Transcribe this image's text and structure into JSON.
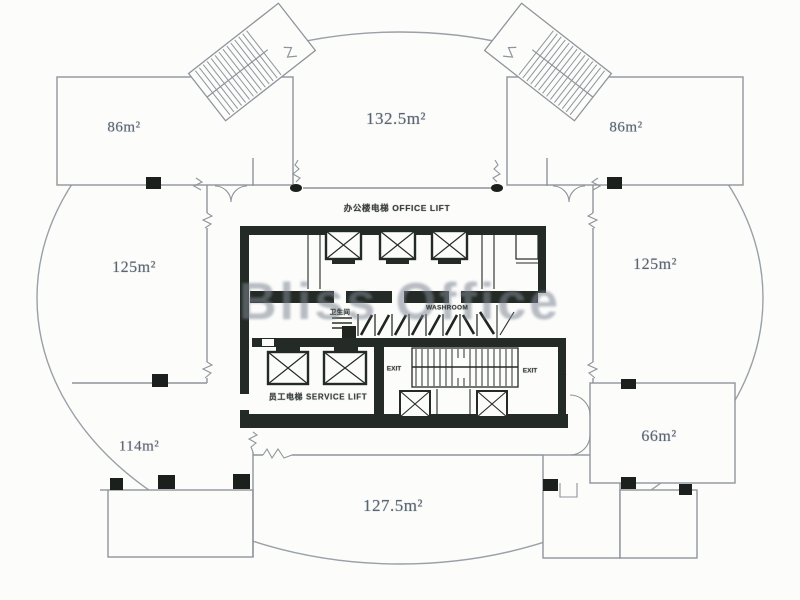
{
  "watermark": "Bliss Office",
  "rooms": {
    "top_left": "86m²",
    "top_center": "132.5m²",
    "top_right": "86m²",
    "mid_left": "125m²",
    "mid_right": "125m²",
    "bottom_left": "114m²",
    "bottom_center": "127.5m²",
    "bottom_right": "66m²"
  },
  "core": {
    "office_lift": "办公楼电梯  OFFICE LIFT",
    "service_lift": "员工电梯  SERVICE LIFT",
    "washroom_cn": "卫生间",
    "washroom_en": "WASHROOM",
    "exit_left": "EXIT",
    "exit_right": "EXIT"
  },
  "colors": {
    "wall_line": "#8f949b",
    "core_wall": "#242a25",
    "column": "#1b201c",
    "room_label": "#5a6572",
    "watermark": "#7d8794",
    "background": "#fcfcfb"
  }
}
